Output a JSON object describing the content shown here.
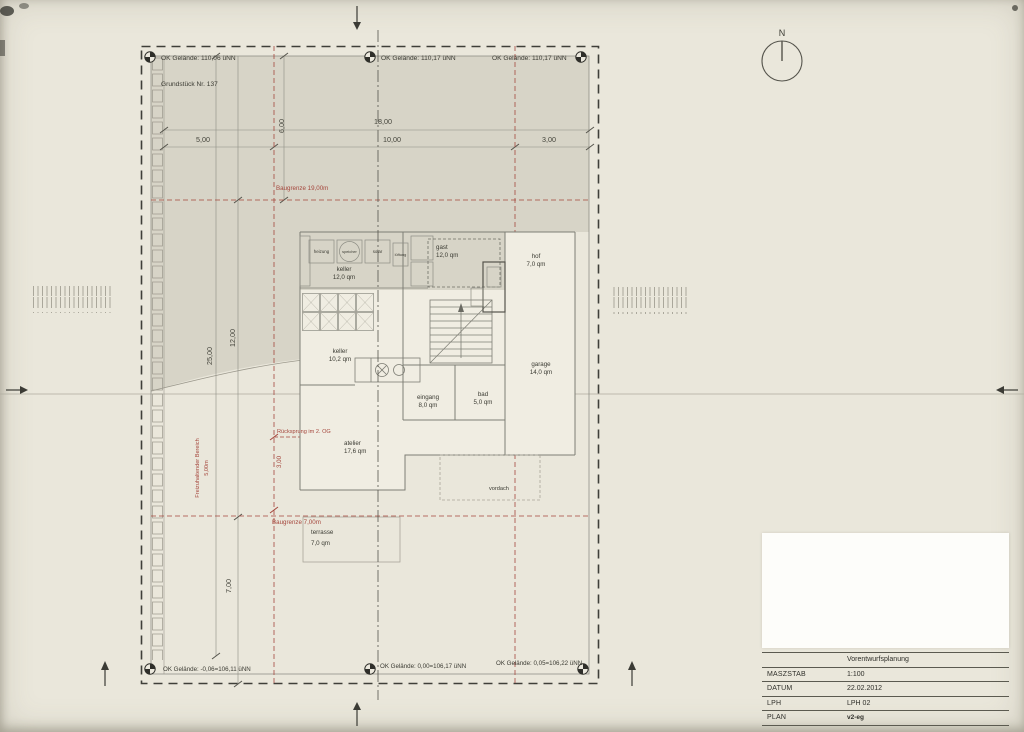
{
  "colors": {
    "paper": "#eae7db",
    "terrain_shade": "#d5d2c6",
    "line": "#7e7e75",
    "baugrenze_red": "#a5473d",
    "ink": "#3b3b33",
    "titleblock_white": "#fdfdfa"
  },
  "north_label": "N",
  "survey": {
    "top_left": "OK Gelände: 110,06 üNN",
    "top_mid": "OK Gelände: 110,17 üNN",
    "top_right": "OK Gelände: 110,17 üNN",
    "parcel": "Grundstück Nr. 137",
    "bottom_left": "OK Gelände: -0,06=106,11 üNN",
    "bottom_mid": "OK Gelände: 0,00=106,17 üNN",
    "bottom_right": "OK Gelände: 0,05=106,22 üNN"
  },
  "dims": {
    "total": "18,00",
    "seg_left": "5,00",
    "seg_mid": "10,00",
    "seg_right": "3,00",
    "top_offset": "6,00",
    "depth_total": "25,00",
    "depth_upper": "12,00",
    "depth_lower": "7,00"
  },
  "boundaries": {
    "baugrenze_top": "Baugrenze 19,00m",
    "baugrenze_bottom": "Baugrenze 7,00m",
    "keepout_line1": "Freizuhaltender Bereich",
    "keepout_line2": "5,00m",
    "ruecksprung": "Rücksprung im 2. OG",
    "setback_dim": "3,00"
  },
  "rooms": {
    "heizung": {
      "name": "heizung"
    },
    "speicher": {
      "name": "speicher"
    },
    "solar": {
      "name": "solar"
    },
    "lueftung": {
      "name": "lüftung"
    },
    "keller1": {
      "name": "keller",
      "area": "12,0 qm"
    },
    "gast": {
      "name": "gast",
      "area": "12,0 qm"
    },
    "hof": {
      "name": "hof",
      "area": "7,0 qm"
    },
    "keller2": {
      "name": "keller",
      "area": "10,2 qm"
    },
    "garage": {
      "name": "garage",
      "area": "14,0 qm"
    },
    "eingang": {
      "name": "eingang",
      "area": "8,0 qm"
    },
    "bad": {
      "name": "bad",
      "area": "5,0 qm"
    },
    "atelier": {
      "name": "atelier",
      "area": "17,6 qm"
    },
    "terrasse": {
      "name": "terrasse",
      "area": "7,0 qm"
    },
    "vordach": {
      "name": "vordach"
    }
  },
  "titleblock": {
    "header_label": "",
    "title": "Vorentwurfsplanung",
    "rows": [
      {
        "label": "MASZSTAB",
        "value": "1:100"
      },
      {
        "label": "DATUM",
        "value": "22.02.2012"
      },
      {
        "label": "LPH",
        "value": "LPH 02"
      },
      {
        "label": "PLAN",
        "value": "v2-eg"
      }
    ]
  }
}
